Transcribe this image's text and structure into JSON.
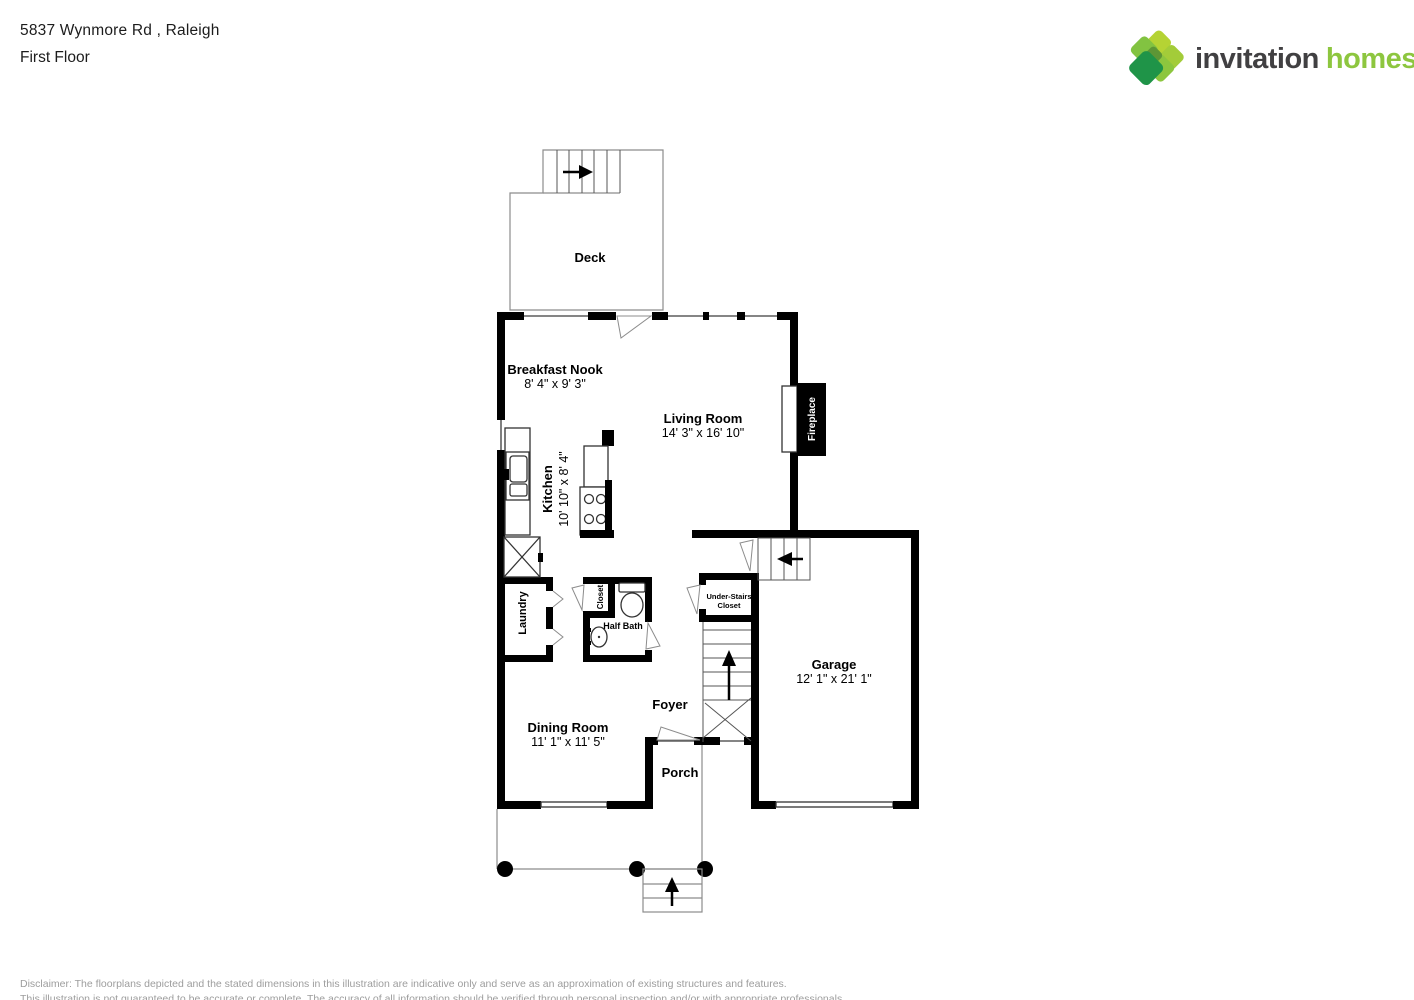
{
  "header": {
    "address": "5837 Wynmore Rd , Raleigh",
    "floor": "First Floor"
  },
  "logo": {
    "word1": "invitation",
    "word2": "homes",
    "trademark": "™",
    "word1_color": "#414042",
    "word2_color": "#8dc63f",
    "diamond_colors": [
      "#b5d334",
      "#a3cc39",
      "#82c341",
      "#8cc63e",
      "#5d9636",
      "#1f9448"
    ]
  },
  "rooms": {
    "deck": {
      "name": "Deck"
    },
    "breakfast_nook": {
      "name": "Breakfast Nook",
      "dims": "8' 4\" x 9' 3\""
    },
    "living_room": {
      "name": "Living Room",
      "dims": "14' 3\" x 16' 10\""
    },
    "kitchen": {
      "name": "Kitchen",
      "dims": "10' 10\" x 8' 4\""
    },
    "laundry": {
      "name": "Laundry"
    },
    "closet": {
      "name": "Closet"
    },
    "half_bath": {
      "name": "Half Bath"
    },
    "under_stairs_closet": {
      "line1": "Under-Stairs",
      "line2": "Closet"
    },
    "foyer": {
      "name": "Foyer"
    },
    "garage": {
      "name": "Garage",
      "dims": "12' 1\" x 21' 1\""
    },
    "dining_room": {
      "name": "Dining Room",
      "dims": "11' 1\" x 11' 5\""
    },
    "porch": {
      "name": "Porch"
    },
    "fireplace": {
      "name": "Fireplace"
    }
  },
  "disclaimer": {
    "line1": "Disclaimer: The floorplans depicted and the stated dimensions in this illustration are indicative only and serve as an approximation of existing structures and features.",
    "line2": "This illustration is not guaranteed to be accurate or complete. The accuracy of all information should be verified through personal inspection and/or with appropriate professionals."
  }
}
